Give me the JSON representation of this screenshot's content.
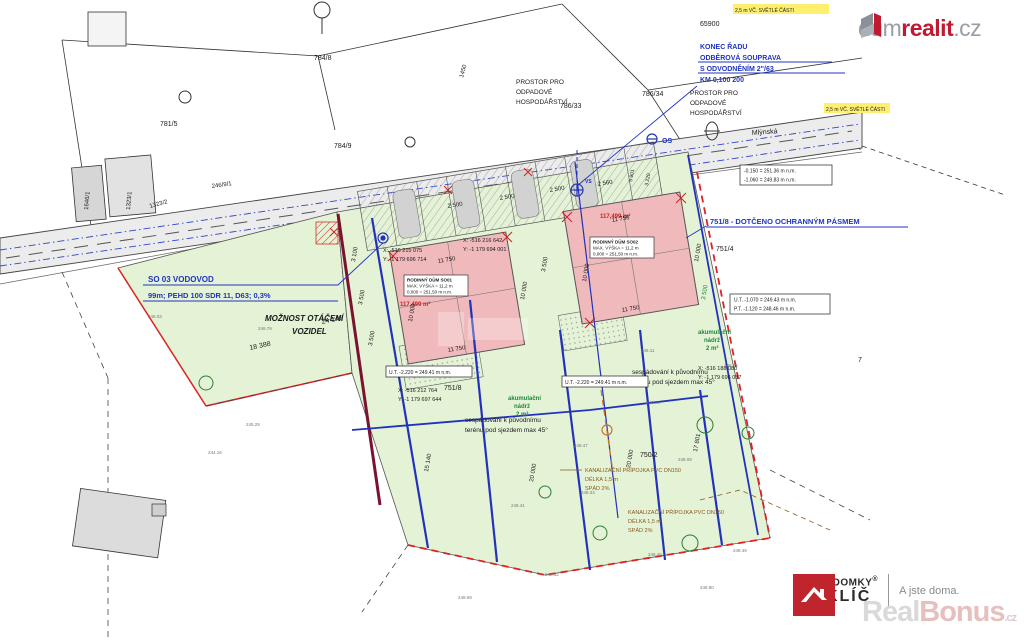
{
  "branding": {
    "logo_top": {
      "part1": "dum",
      "part2": "realit",
      "part3": ".cz"
    },
    "logo_bottom": {
      "brand_line1": "ZDĚNÉ DOMKY",
      "reg": "®",
      "brand_line2": "NA KLÍČ",
      "tagline": "A jste doma."
    },
    "watermark": {
      "part1": "Real",
      "part2": "Bonus",
      "part3": ".cz"
    }
  },
  "colors": {
    "accent_red": "#c01932",
    "plan_green": "#e4f2d6",
    "building_pink": "#f0b9bc",
    "utility_blue": "#2233bb",
    "boundary_red": "#dd2222",
    "retaining_wall_maroon": "#7a1230",
    "road_gray": "#ececec",
    "annotation_blue": "#1f35c0"
  },
  "plan": {
    "street": "Mlýnská",
    "notes": {
      "konec1": "KONEC ŘADU",
      "konec2": "ODBĚROVÁ SOUPRAVA",
      "konec3": "S ODVODNĚNÍM 2\"/63",
      "konec4": "KM 0,100 200",
      "vodovod1": "SO 03 VODOVOD",
      "vodovod2": "99m; PEHD 100 SDR 11, D63; 0,3%",
      "dotceno": "751/8 - DOTČENO OCHRANNÝM PÁSMEM",
      "moznost1": "MOŽNOST OTÁČENÍ",
      "moznost2": "VOZIDEL",
      "prostor1": "PROSTOR PRO",
      "prostor2": "ODPADOVÉ",
      "prostor3": "HOSPODÁŘSTVÍ",
      "sespad1": "sespádování k původnímu",
      "sespad2": "terénu pod sjezdem max 45°",
      "akumulacni1": "akumulační",
      "akumulacni2": "nádrž",
      "akumulacni3": "2 m³",
      "kanal1": "KANALIZAČNÍ PŘÍPOJKA PVC DN150",
      "kanal2": "DÉLKA 1,5 m",
      "kanal3": "SPÁD 2%",
      "os": "OS",
      "vs": "VS",
      "yellow1": "2,5 m VČ. SVĚTLÉ ČÁSTI"
    },
    "buildings": [
      {
        "title": "RODINNÝ DŮM SO01",
        "height": "MAX. VÝŠKA = 11,2 m",
        "zero": "0,000 = 251,50 m n.m.",
        "area": "117,499 m²"
      },
      {
        "title": "RODINNÝ DŮM SO02",
        "height": "MAX. VÝŠKA = 11,2 m",
        "zero": "0,000 = 251,50 m n.m.",
        "area": "117,499 m²"
      }
    ],
    "parcel_labels": [
      "65900",
      "784/8",
      "781/5",
      "784/9",
      "786/33",
      "786/34",
      "1450",
      "1646/1",
      "1323/1",
      "1323/2",
      "246/9/1",
      "751/4",
      "751/8",
      "750/2",
      "7"
    ],
    "dims": [
      "11 750",
      "11 750",
      "10 000",
      "10 000",
      "11 750",
      "11 750",
      "10 000",
      "10 000",
      "3 100",
      "3 500",
      "3 500",
      "3 500",
      "3 500",
      "2 500",
      "2 500",
      "2 500",
      "2 560",
      "5 901",
      "3 220",
      "24 146",
      "18 388",
      "20 000",
      "20 000",
      "17 801",
      "15 140"
    ],
    "coords": [
      "X: -516 215 075",
      "Y: -1 179 696 714",
      "X: -516 212 764",
      "Y: -1 179 697 644",
      "X: -516 216 642",
      "Y: -1 179 694 001",
      "X: -516 188 080",
      "Y: -1 179 696 087"
    ],
    "level_boxes": [
      "-0.150 = 251.36 m n.m.",
      "-1.060 = 249.83 m n.m.",
      "U.T. -1.070 = 249.43 m n.m.",
      "P.T. -1.120 = 248.46 m n.m.",
      "U.T. -2.220 = 249.41 m n.m.",
      "U.T. -2.220 = 249.41 m n.m."
    ],
    "spot_elevations": [
      "248.62",
      "248.69",
      "248.80",
      "248.45",
      "248.49",
      "246.11",
      "248.51",
      "248.47",
      "246.22",
      "248.33",
      "248.09",
      "244.16",
      "246.03",
      "246.79",
      "245.29",
      "248.41"
    ]
  }
}
